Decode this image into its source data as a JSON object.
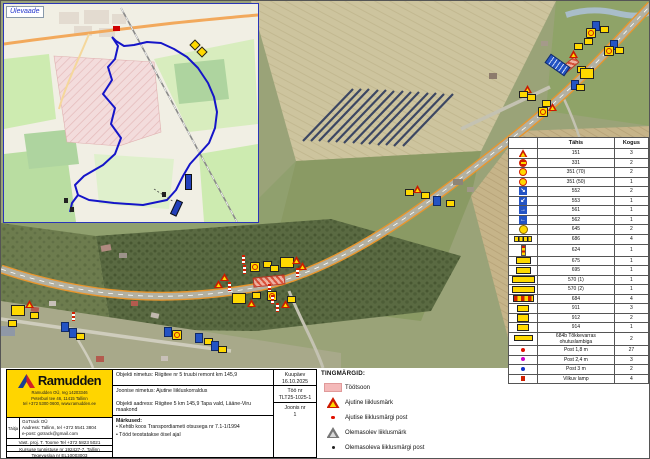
{
  "colors": {
    "ramudden_yellow": "#ffd500",
    "work_zone_pink": "#f4b9b9",
    "detour_route_blue": "#1515c8",
    "sign_yellow": "#ffd900",
    "sign_red": "#d01f00",
    "sign_blue": "#2353c4"
  },
  "inset": {
    "label": "Ülevaade"
  },
  "sign_table": {
    "header": {
      "type_label": "Tähis",
      "qty_label": "Kogus"
    },
    "rows": [
      {
        "icon": "tri",
        "code": "151",
        "count": "3"
      },
      {
        "icon": "noentry",
        "code": "331",
        "count": "2"
      },
      {
        "icon": "speed",
        "code": "351 (70)",
        "count": "2"
      },
      {
        "icon": "speed",
        "code": "351 (50)",
        "count": "1"
      },
      {
        "icon": "bsq",
        "glyph": "↘",
        "code": "552",
        "count": "2"
      },
      {
        "icon": "bsq",
        "glyph": "↙",
        "code": "553",
        "count": "1"
      },
      {
        "icon": "bsq",
        "glyph": "→",
        "code": "561",
        "count": "1"
      },
      {
        "icon": "bsq",
        "glyph": "←",
        "code": "562",
        "count": "1"
      },
      {
        "icon": "lamp",
        "code": "645",
        "count": "2"
      },
      {
        "icon": "bar",
        "code": "686",
        "count": "4"
      },
      {
        "icon": "postic",
        "code": "624",
        "count": "1"
      },
      {
        "icon": "arr",
        "code": "675",
        "count": "1"
      },
      {
        "icon": "arr2",
        "code": "695",
        "count": "1"
      },
      {
        "icon": "long",
        "code": "570 (1)",
        "count": "1"
      },
      {
        "icon": "long",
        "code": "570 (2)",
        "count": "1"
      },
      {
        "icon": "barrier",
        "code": "684",
        "count": "4"
      },
      {
        "icon": "p911",
        "code": "911",
        "count": "3"
      },
      {
        "icon": "p911",
        "code": "912",
        "count": "2"
      },
      {
        "icon": "p911",
        "code": "914",
        "count": "1"
      },
      {
        "icon": "wide",
        "code": "684b Tõkkevarras ohutuslambiga",
        "count": "2"
      },
      {
        "icon": "dot-red",
        "code": "Post 1,8 m",
        "count": "27"
      },
      {
        "icon": "dot-mag",
        "code": "Post 2,4 m",
        "count": "3"
      },
      {
        "icon": "dot-blue",
        "code": "Post 3 m",
        "count": "2"
      },
      {
        "icon": "sq-red",
        "code": "Vilkuv lamp",
        "count": "4"
      }
    ]
  },
  "tingmargid": {
    "title": "TINGMÄRGID:",
    "items": [
      {
        "icon": "zone",
        "label": "Töötsoon"
      },
      {
        "icon": "atri",
        "label": "Ajutine liiklusmärk"
      },
      {
        "icon": "rdot",
        "label": "Ajutise liiklusmärgi post"
      },
      {
        "icon": "gtri",
        "label": "Olemasolev liiklusmärk"
      },
      {
        "icon": "bdot",
        "label": "Olemasoleva liiklusmärgi post"
      }
    ]
  },
  "info": {
    "company": {
      "name": "Ramudden",
      "address_lines": [
        "Ramudden OÜ, reg 14203346",
        "Peterburi tee 46, 11415 Tallinn",
        "tel +372 5300 0600, www.ramudden.ee"
      ]
    },
    "contractor": {
      "label": "Täitja",
      "lines": [
        "GoTrack OÜ",
        "Aadress: Tallinn, tel +372 5541 3804",
        "e-post: gotrack@gmail.com"
      ]
    },
    "strips": [
      "Vast. proj. T. Toome Tel +372 5823 5021",
      "Kursuse tunnistuse nr 192427-7, Tallinn",
      "Tegevusloa nr EL10003003"
    ],
    "fields": {
      "object_name": "Objekti nimetus: Riigitee nr 5 truubi remont km 145,9",
      "drawing_name": "Joonise nimetus: Ajutine liikluskorraldus",
      "object_address": "Objekti aadress: Riigitee 5 km 145,9 Tapa vald, Lääne-Viru maakond",
      "notes_title": "Märkused:",
      "notes": [
        "Kehtib koos Transpordiameti otsusega nr 7.1-1/1994",
        "Tööd teostatakse öisel ajal"
      ],
      "date_label": "Kuupäev",
      "date": "16.10.2025",
      "work_no_label": "Töö nr",
      "work_no": "TLT25-1025-1",
      "drawing_no_label": "Joonis nr",
      "drawing_no": "1"
    }
  },
  "map": {
    "markers": [
      {
        "type": "wz",
        "x": 560,
        "y": 60,
        "w": 16,
        "h": 6,
        "r": -40
      },
      {
        "type": "blue",
        "x": 591,
        "y": 20
      },
      {
        "type": "ybr",
        "x": 585,
        "y": 27
      },
      {
        "type": "yb",
        "x": 599,
        "y": 25
      },
      {
        "type": "blue",
        "x": 609,
        "y": 39
      },
      {
        "type": "ybr",
        "x": 603,
        "y": 45
      },
      {
        "type": "yb",
        "x": 614,
        "y": 46
      },
      {
        "type": "yb",
        "x": 583,
        "y": 37
      },
      {
        "type": "tri",
        "x": 568,
        "y": 49
      },
      {
        "type": "yb",
        "x": 573,
        "y": 42
      },
      {
        "type": "bigblue",
        "x": 551,
        "y": 52,
        "r": -55
      },
      {
        "type": "yb",
        "x": 576,
        "y": 65
      },
      {
        "type": "yb2",
        "x": 579,
        "y": 67
      },
      {
        "type": "blue",
        "x": 570,
        "y": 79
      },
      {
        "type": "yb",
        "x": 575,
        "y": 83
      },
      {
        "type": "tri",
        "x": 522,
        "y": 84
      },
      {
        "type": "yb",
        "x": 518,
        "y": 90
      },
      {
        "type": "yb",
        "x": 526,
        "y": 93
      },
      {
        "type": "yb",
        "x": 541,
        "y": 99
      },
      {
        "type": "ybr",
        "x": 537,
        "y": 106
      },
      {
        "type": "tri",
        "x": 547,
        "y": 102
      },
      {
        "type": "yb",
        "x": 404,
        "y": 188
      },
      {
        "type": "tri",
        "x": 412,
        "y": 184
      },
      {
        "type": "yb",
        "x": 420,
        "y": 191
      },
      {
        "type": "blue",
        "x": 432,
        "y": 195
      },
      {
        "type": "yb",
        "x": 445,
        "y": 199
      },
      {
        "type": "wz",
        "x": 252,
        "y": 275,
        "w": 30,
        "h": 8,
        "r": -6
      },
      {
        "type": "post",
        "x": 241,
        "y": 254
      },
      {
        "type": "post",
        "x": 242,
        "y": 264
      },
      {
        "type": "ybr",
        "x": 249,
        "y": 261
      },
      {
        "type": "yb",
        "x": 262,
        "y": 260
      },
      {
        "type": "yb",
        "x": 269,
        "y": 264
      },
      {
        "type": "yb2",
        "x": 279,
        "y": 256
      },
      {
        "type": "tri",
        "x": 291,
        "y": 255
      },
      {
        "type": "tri",
        "x": 297,
        "y": 261
      },
      {
        "type": "post",
        "x": 295,
        "y": 267
      },
      {
        "type": "tri",
        "x": 219,
        "y": 272
      },
      {
        "type": "tri",
        "x": 213,
        "y": 279
      },
      {
        "type": "post",
        "x": 227,
        "y": 281
      },
      {
        "type": "yb2",
        "x": 231,
        "y": 292
      },
      {
        "type": "yb",
        "x": 251,
        "y": 291
      },
      {
        "type": "tri",
        "x": 246,
        "y": 298
      },
      {
        "type": "post",
        "x": 267,
        "y": 283
      },
      {
        "type": "ybr",
        "x": 266,
        "y": 290
      },
      {
        "type": "post",
        "x": 270,
        "y": 294
      },
      {
        "type": "post",
        "x": 275,
        "y": 302
      },
      {
        "type": "tri",
        "x": 280,
        "y": 299
      },
      {
        "type": "yb",
        "x": 286,
        "y": 295
      },
      {
        "type": "yb2",
        "x": 10,
        "y": 304
      },
      {
        "type": "tri",
        "x": 24,
        "y": 299
      },
      {
        "type": "yb",
        "x": 29,
        "y": 311
      },
      {
        "type": "yb",
        "x": 7,
        "y": 319
      },
      {
        "type": "post",
        "x": 71,
        "y": 311
      },
      {
        "type": "blue",
        "x": 60,
        "y": 321
      },
      {
        "type": "blue",
        "x": 68,
        "y": 327
      },
      {
        "type": "yb",
        "x": 75,
        "y": 332
      },
      {
        "type": "blue",
        "x": 163,
        "y": 326
      },
      {
        "type": "ybr",
        "x": 171,
        "y": 329
      },
      {
        "type": "blue",
        "x": 194,
        "y": 332
      },
      {
        "type": "yb",
        "x": 203,
        "y": 337
      },
      {
        "type": "blue",
        "x": 210,
        "y": 340
      },
      {
        "type": "yb",
        "x": 217,
        "y": 345
      }
    ],
    "inset_markers": [
      {
        "type": "ired",
        "x": 109,
        "y": 22
      },
      {
        "type": "ydia",
        "x": 187,
        "y": 37
      },
      {
        "type": "ydia",
        "x": 194,
        "y": 44
      },
      {
        "type": "bbar",
        "x": 181,
        "y": 170
      },
      {
        "type": "bbar",
        "x": 169,
        "y": 196,
        "r": 25
      },
      {
        "type": "blk",
        "x": 60,
        "y": 194
      },
      {
        "type": "blk",
        "x": 66,
        "y": 203
      },
      {
        "type": "blk",
        "x": 158,
        "y": 188
      }
    ]
  }
}
